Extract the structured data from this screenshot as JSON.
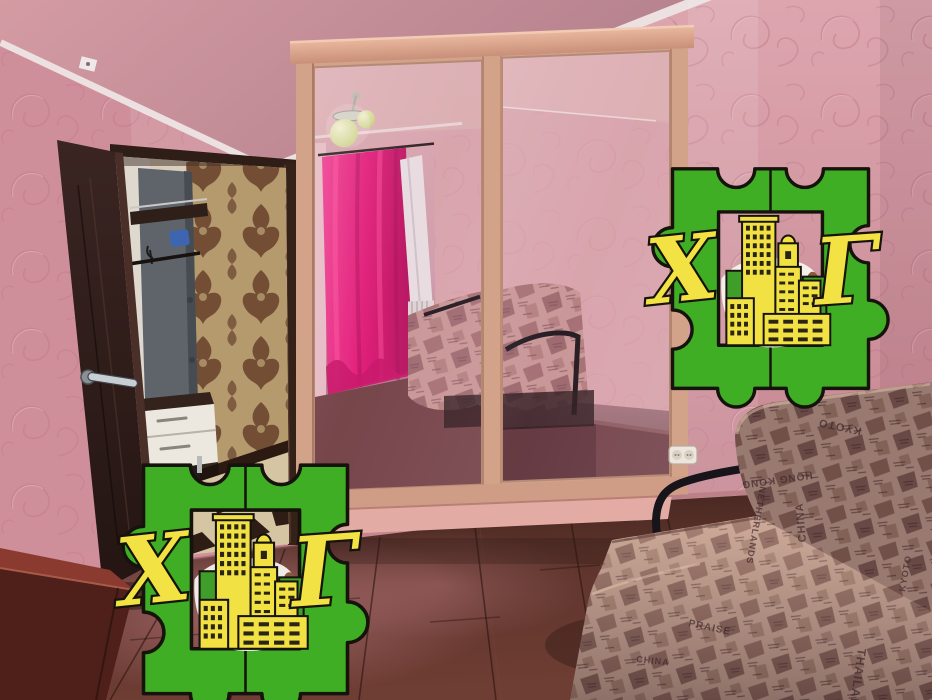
{
  "watermark": {
    "letter_left": "Х",
    "letter_right": "Г",
    "colors": {
      "frame_green": "#3fae25",
      "letters_yellow": "#f3e243",
      "outline_black": "#16120c",
      "buildings_yellow": "#f1e143",
      "buildings_back_green": "#3f9e2a",
      "cow_spot_brown": "#8a5a3c"
    }
  },
  "sofa": {
    "fabric_words": [
      "KYOTO",
      "HONG KONG",
      "CHINA",
      "THAILAND",
      "NETHERLANDS",
      "PRAISE"
    ]
  },
  "palette": {
    "wall_pink": "#d697a0",
    "ceiling_pink": "#c28b94",
    "molding_white": "#ece0e1",
    "hallway_damask_base": "#c6ab7c",
    "hallway_damask_motif": "#6d4730",
    "door_brown": "#34211d",
    "wardrobe_frame_beige": "#d2a289",
    "mirror_tint": "#d8a6ae",
    "curtain_magenta": "#e21678",
    "floor_brown": "#5d342c",
    "sofa_fabric": "#c2a191"
  }
}
